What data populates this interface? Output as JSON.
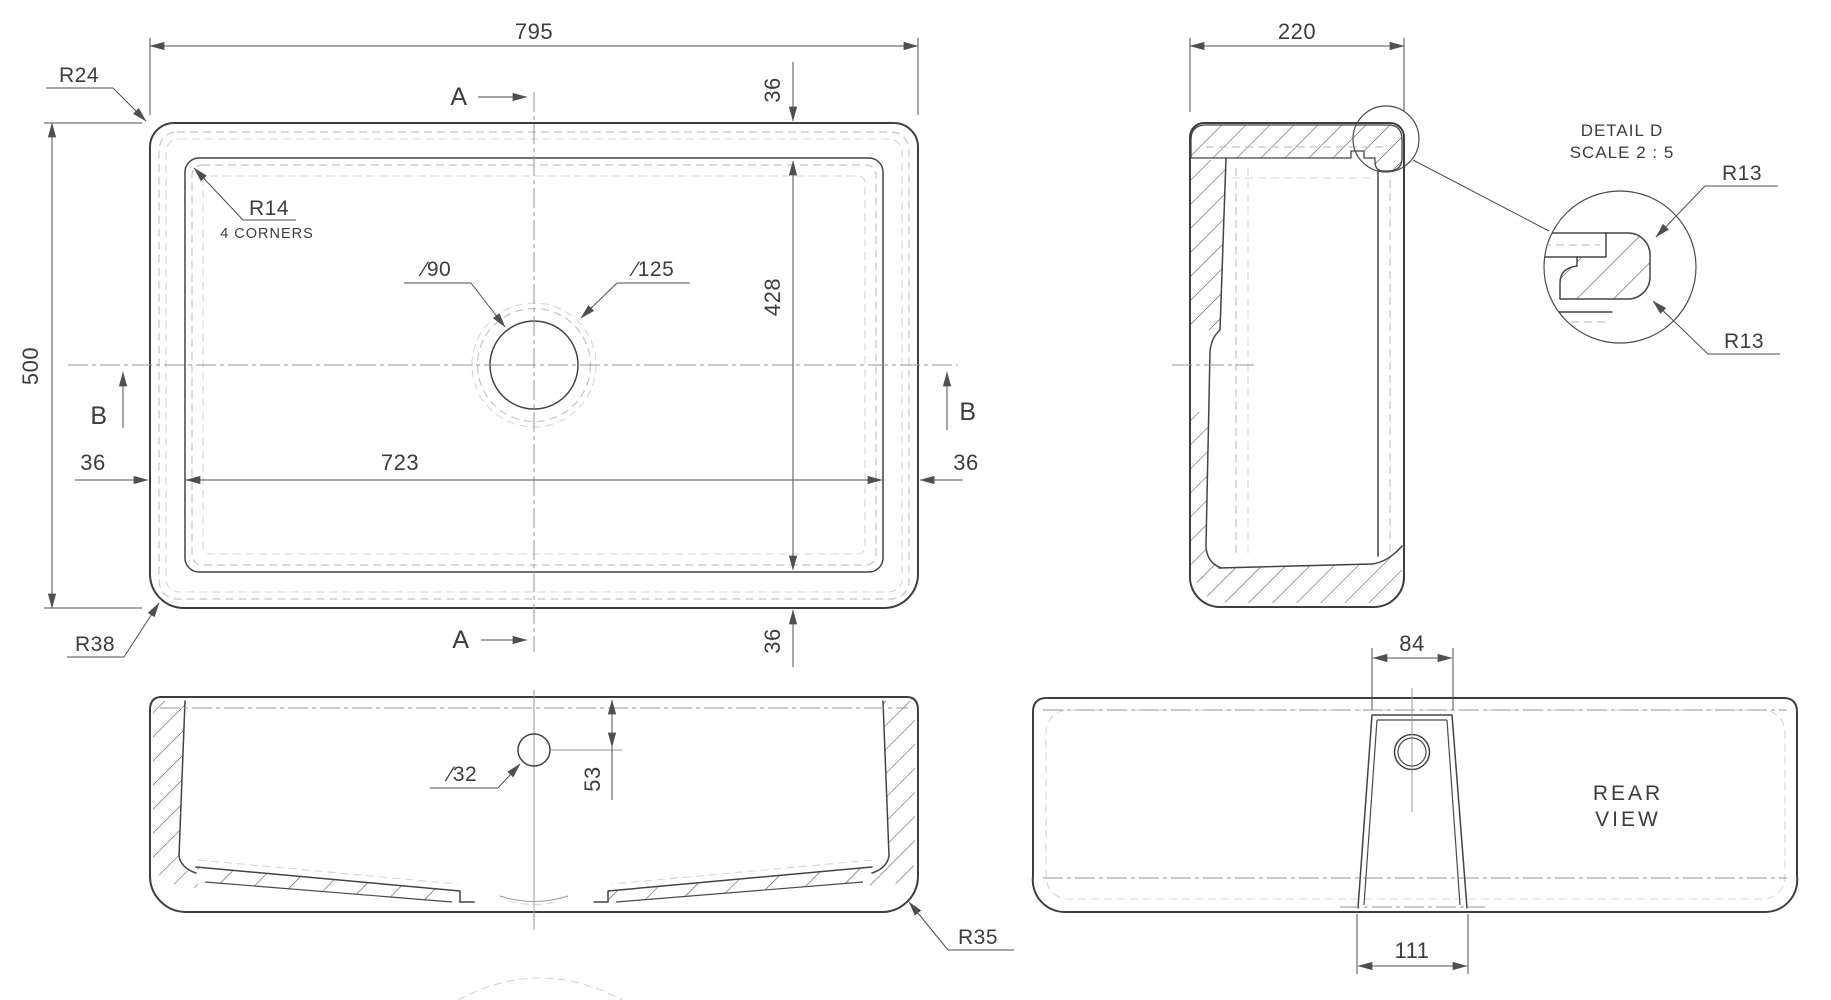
{
  "drawing": {
    "plan": {
      "dim_width": "795",
      "dim_height": "500",
      "dim_inner_width": "723",
      "dim_left_offset": "36",
      "dim_right_offset": "36",
      "dim_top_offset": "36",
      "dim_inner_height": "428",
      "dim_bottom_offset": "36",
      "corner_radius_outer": "R24",
      "corner_radius_inner": "R14",
      "corner_radius_inner_note": "4 CORNERS",
      "corner_radius_front": "R38",
      "drain_diameter": "∕90",
      "recess_diameter": "∕125",
      "section_a": "A",
      "section_b": "B"
    },
    "side": {
      "dim_depth": "220"
    },
    "detail": {
      "title": "DETAIL D",
      "scale": "SCALE 2 : 5",
      "radius_top": "R13",
      "radius_bottom": "R13"
    },
    "front": {
      "overflow_diameter": "∕32",
      "overflow_depth": "53",
      "corner_radius": "R35"
    },
    "rear": {
      "dim_top": "84",
      "dim_bottom": "111",
      "caption_line1": "REAR",
      "caption_line2": "VIEW"
    }
  },
  "colors": {
    "background": "#ffffff",
    "visible_edge": "#3e3e3e",
    "hidden_edge": "#c4c4c4",
    "centerline": "#949494",
    "dimension": "#4f4f4f",
    "text": "#3c3c3c"
  }
}
